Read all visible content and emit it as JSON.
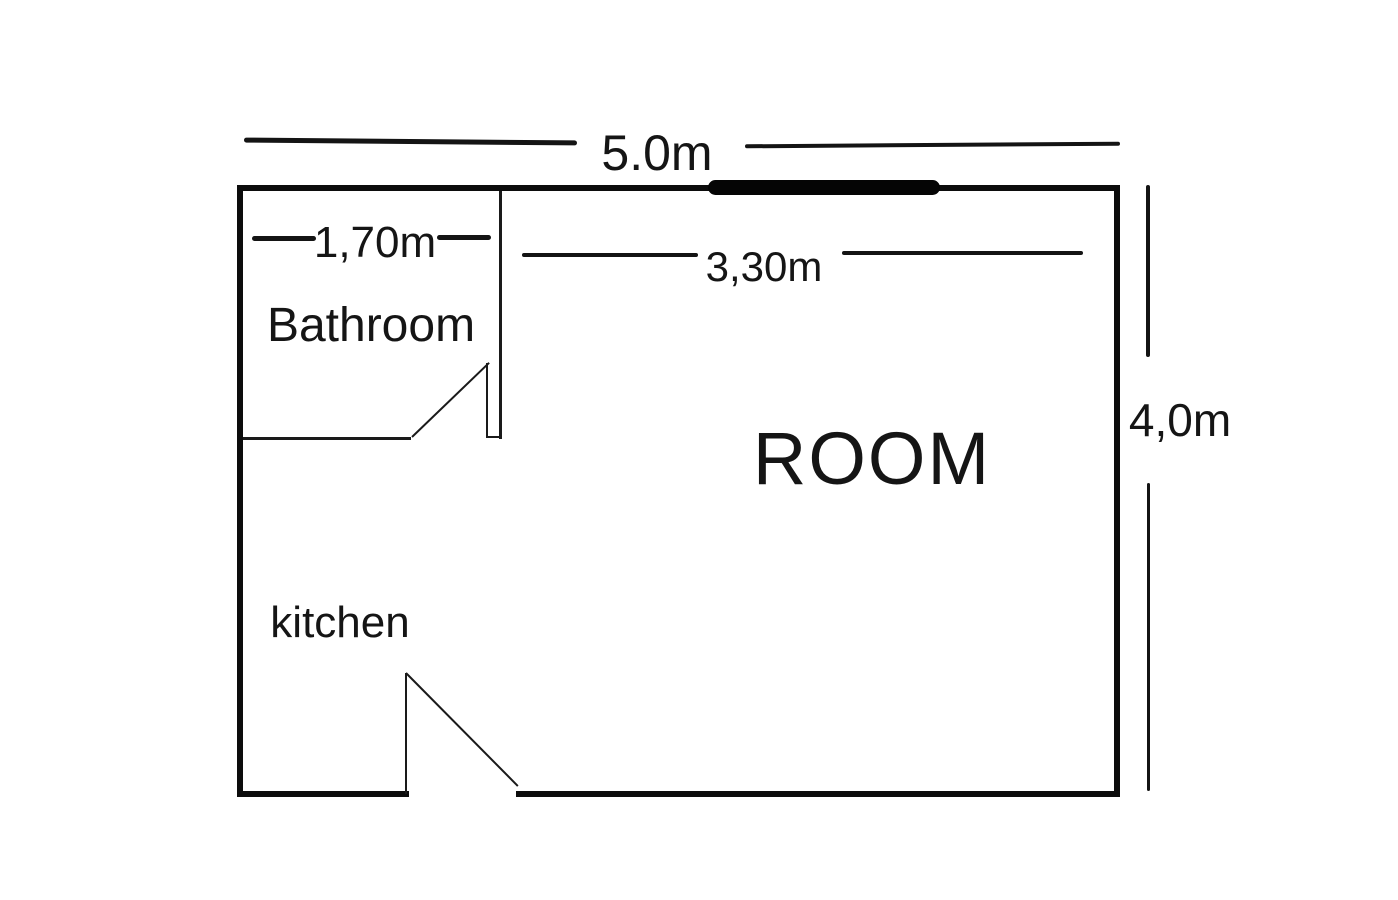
{
  "diagram": {
    "type": "floor-plan",
    "background": "#ffffff",
    "ink_color": "#111111",
    "rooms": {
      "bathroom": {
        "label": "Bathroom"
      },
      "main_room": {
        "label": "ROOM"
      },
      "kitchen": {
        "label": "kitchen"
      }
    },
    "dimensions": {
      "total_width": {
        "label": "5.0m"
      },
      "bathroom_width": {
        "label": "1,70m"
      },
      "room_width": {
        "label": "3,30m"
      },
      "total_height": {
        "label": "4,0m"
      }
    },
    "symbols": {
      "window": "window-bar-icon",
      "doors": [
        "bathroom-door-swing",
        "kitchen-door-swing"
      ]
    }
  }
}
